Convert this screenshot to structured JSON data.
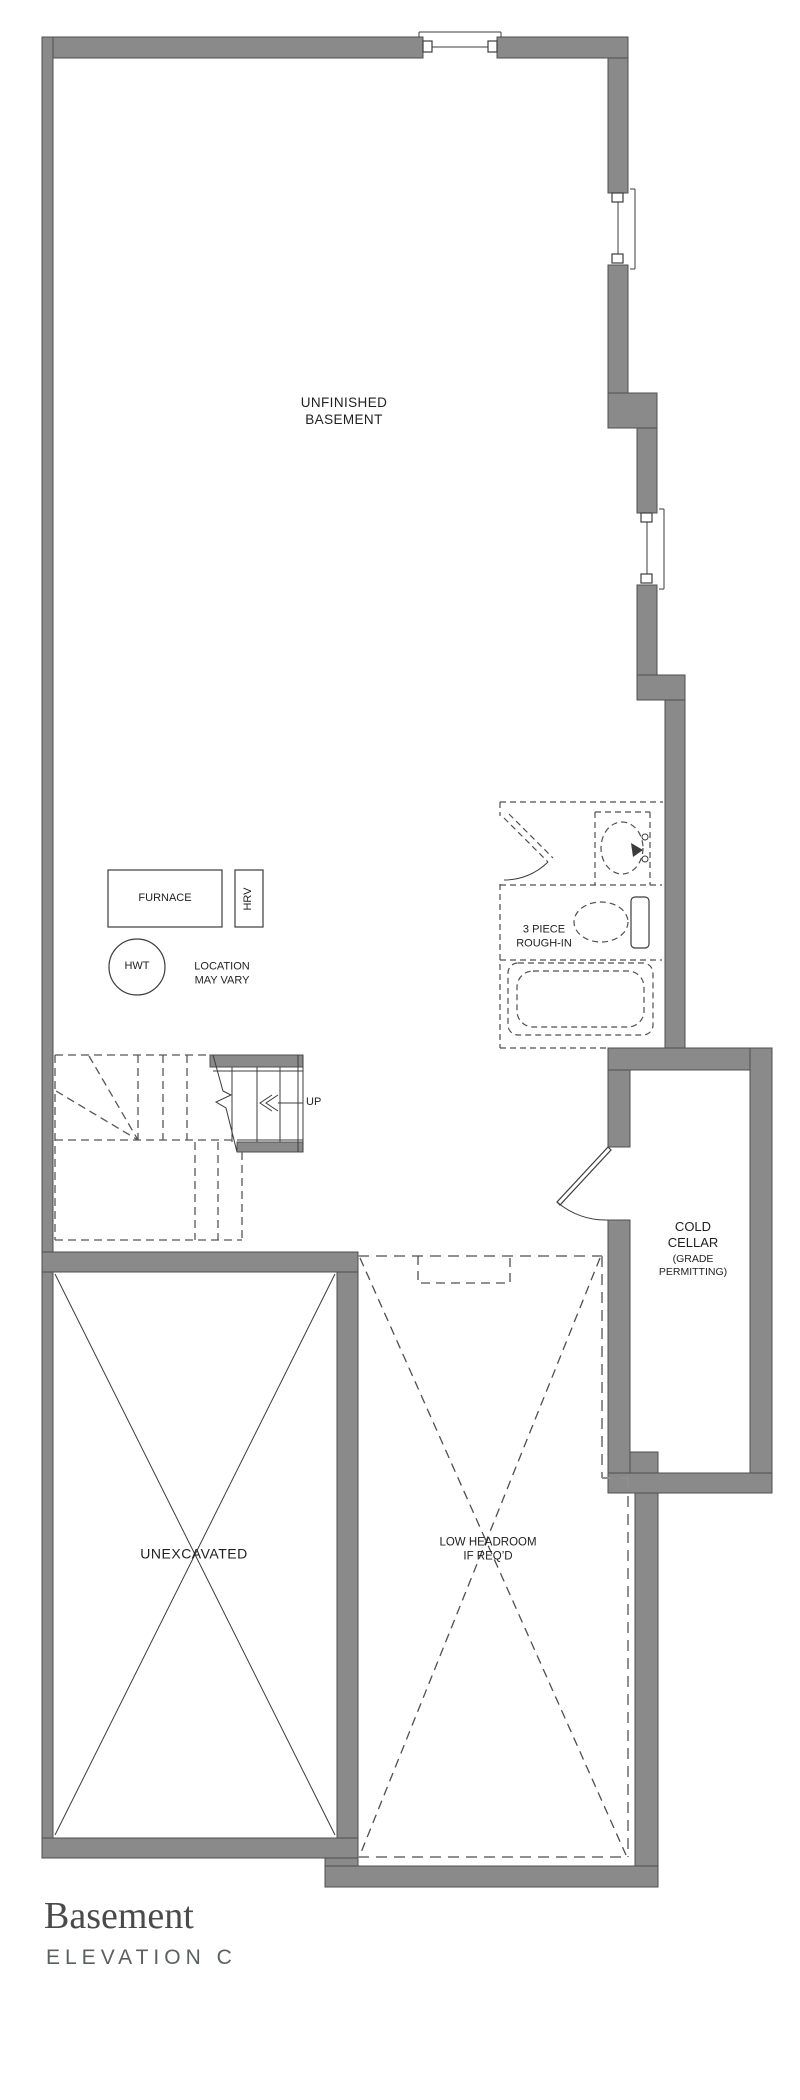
{
  "colors": {
    "wall_fill": "#8a8a8a",
    "wall_stroke": "#4f4f4f",
    "line": "#3c3c3c",
    "dash": "#555555",
    "dash_light": "#8f8f8f",
    "text": "#1f1f1f",
    "title": "#4a4a4a",
    "subtitle": "#5b5f63",
    "background": "#ffffff"
  },
  "rooms": {
    "unfinished_basement": {
      "label": "UNFINISHED\nBASEMENT"
    },
    "bathroom": {
      "label": "3 PIECE\nROUGH-IN"
    },
    "cold_cellar": {
      "label": "COLD\nCELLAR",
      "sublabel": "(GRADE\nPERMITTING)"
    },
    "unexcavated": {
      "label": "UNEXCAVATED"
    },
    "garage": {
      "label": "LOW HEADROOM\nIF REQ’D"
    }
  },
  "equipment": {
    "furnace_label": "FURNACE",
    "hrv_label": "HRV",
    "hwt_label": "HWT",
    "note": "LOCATION\nMAY VARY"
  },
  "stairs": {
    "up_label": "UP"
  },
  "title_block": {
    "plan_name": "Basement",
    "elevation": "ELEVATION C"
  }
}
